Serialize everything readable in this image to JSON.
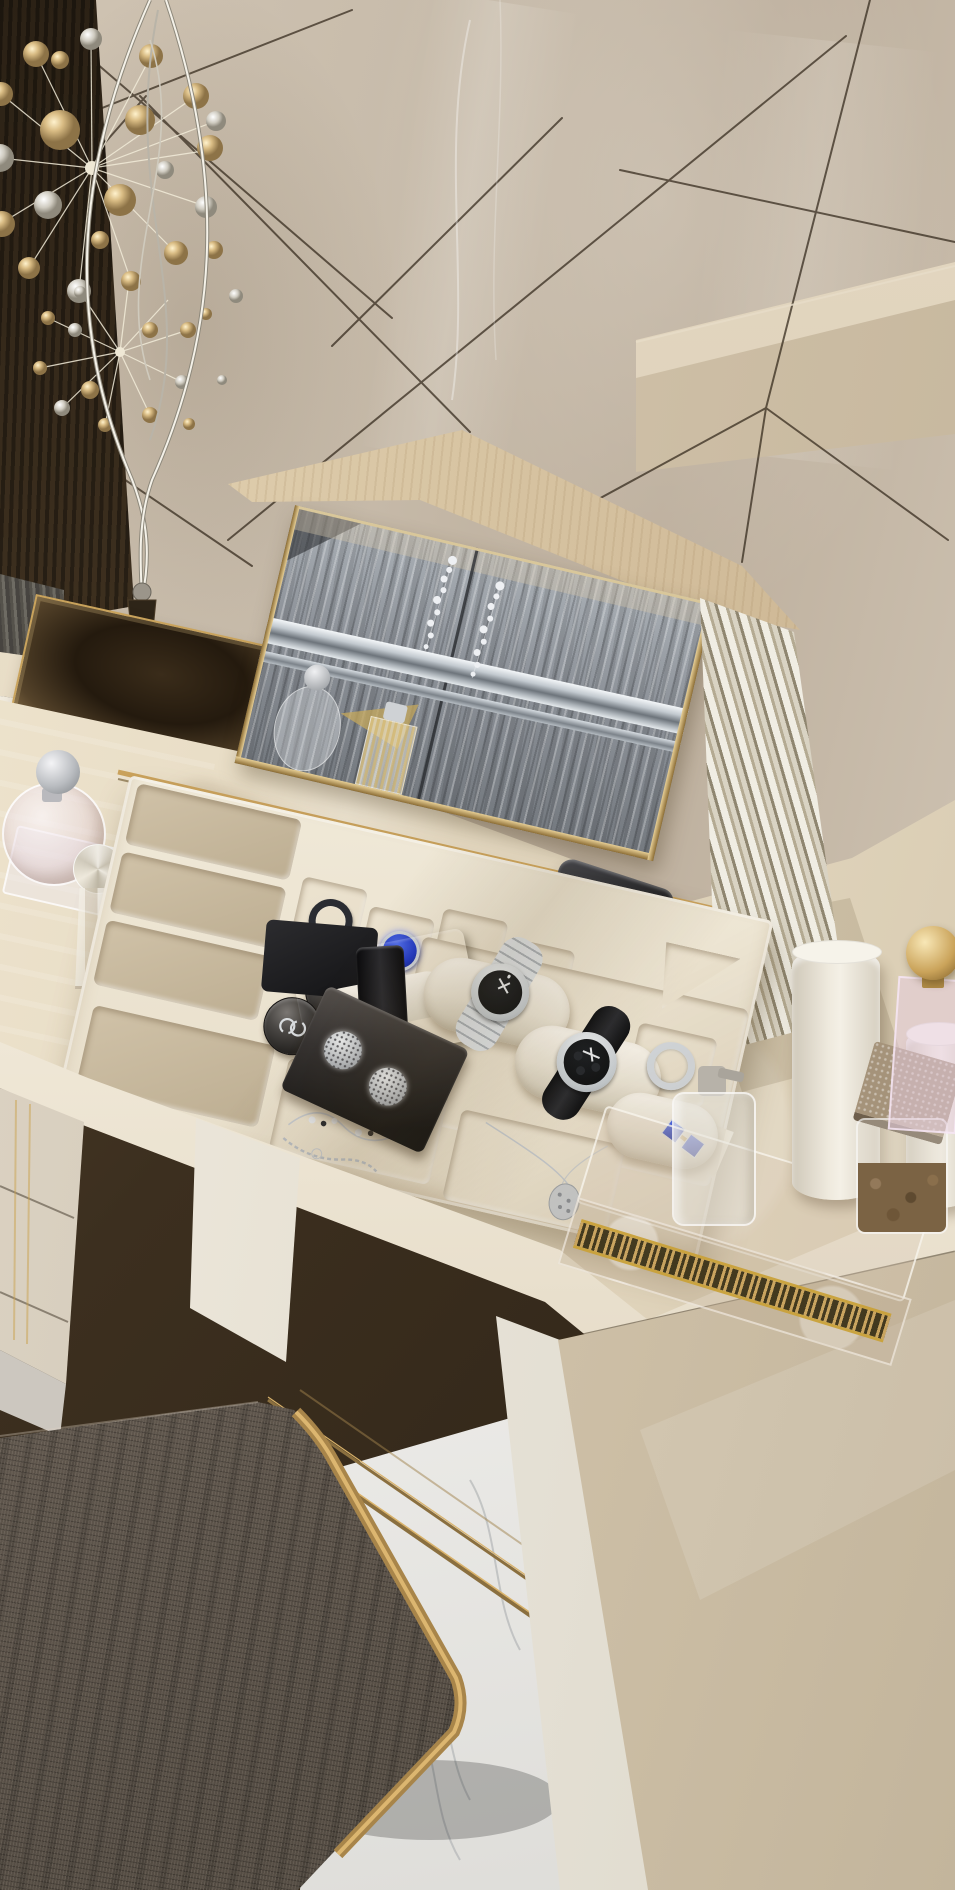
{
  "scene": {
    "type": "photorealistic interior render",
    "setting": "luxury bedroom vanity corner seen from above",
    "description": "A glossy beige vanity dressing table with an open lid revealing a tilted mirror and a cream jewelry organizer tray filled with watches, rings and necklaces. A chrome sputnik-style lamp with golden discs stands on a gold mirrored tray at the left, perfume bottles sit on the marble counter, an acrylic tray with candles and bottles sits on the right counter, and a gray woven stool with gold legs stands on white marble flooring.",
    "objects": [
      {
        "name": "wall-panels",
        "description": "glossy beige wall tiles with thin dark diagonal seams"
      },
      {
        "name": "floating-ledge",
        "description": "beige wall ledge on the right"
      },
      {
        "name": "dark-wood-panel",
        "description": "dark lacquered panel at far left"
      },
      {
        "name": "gray-curtain",
        "description": "striped gray fabric sliver at left edge"
      },
      {
        "name": "sputnik-floor-lamp",
        "description": "chrome twisted-wire lamp with golden disc bursts"
      },
      {
        "name": "gold-mirror-tray",
        "description": "square mirrored brass tray under the lamp base"
      },
      {
        "name": "round-perfume-flacon",
        "description": "round glass flacon with silver ball cap"
      },
      {
        "name": "crystal-perfume-bottle",
        "description": "faceted crystal bottle with sphere stopper"
      },
      {
        "name": "vanity-lid",
        "description": "open beige wooden lid of the vanity"
      },
      {
        "name": "vanity-mirror",
        "description": "mirror on lid underside reflecting gray wavy wardrobe with chrome inlays and crystal tassels"
      },
      {
        "name": "louvered-lid-edge",
        "description": "slatted trim at the right edge of the lid"
      },
      {
        "name": "black-accessory-case",
        "description": "black rounded case behind the tray"
      },
      {
        "name": "jewelry-tray",
        "description": "cream molded organizer with compartments"
      },
      {
        "name": "chanel-jars",
        "description": "two dark round jars with interlocked-C logo"
      },
      {
        "name": "ring-box",
        "description": "open black box with white cushion and black strap"
      },
      {
        "name": "earring-box",
        "description": "black box with two sparkling round medallions"
      },
      {
        "name": "wristwatch-silver",
        "description": "steel bracelet watch with black dial on cushion"
      },
      {
        "name": "wristwatch-chronograph",
        "description": "black strap chronograph on cushion"
      },
      {
        "name": "black-ring",
        "description": "dark ring in back compartment"
      },
      {
        "name": "sapphire-ring",
        "description": "silver ring with large blue stone"
      },
      {
        "name": "silver-ring",
        "description": "plain silver ring in right compartment"
      },
      {
        "name": "sapphire-cufflinks",
        "description": "pair of square blue cufflinks"
      },
      {
        "name": "bead-necklace",
        "description": "thin necklace with alternating beads"
      },
      {
        "name": "chain-bracelet",
        "description": "silver link bracelet"
      },
      {
        "name": "pendant-necklace",
        "description": "chain with oval filigree pendant"
      },
      {
        "name": "marble-countertop",
        "description": "cream marble desktop"
      },
      {
        "name": "gold-hinge-trim",
        "description": "brass trim line along the lid hinge"
      },
      {
        "name": "desk-front-edge",
        "description": "bright lacquered front edge of the desk"
      },
      {
        "name": "left-drawer-unit",
        "description": "glossy drawer fronts at lower left"
      },
      {
        "name": "under-desk-shadow",
        "description": "dark recess below the desktop"
      },
      {
        "name": "acrylic-vanity-tray",
        "description": "clear tray with gold greek-key band"
      },
      {
        "name": "pump-bottle",
        "description": "glass dispenser bottle"
      },
      {
        "name": "pillar-candles",
        "description": "two white cylinder candles"
      },
      {
        "name": "potpourri-jar",
        "description": "glass jar with brown potpourri"
      },
      {
        "name": "pink-acrylic-perfume-stand",
        "description": "lilac acrylic bottle with gold sphere stopper"
      },
      {
        "name": "right-drawer-pedestal",
        "description": "beige pedestal with radiating seams"
      },
      {
        "name": "marble-floor",
        "description": "white marble floor with gray veins"
      },
      {
        "name": "stool-seat",
        "description": "gray-brown woven fabric stool"
      },
      {
        "name": "stool-gold-frame",
        "description": "brass frame, rails and curved legs of the stool"
      }
    ]
  },
  "palette": {
    "wall": "#c8bcab",
    "seam": "#32271a",
    "panelDark": "#2b2115",
    "panelLight": "#4a3a26",
    "curtainA": "#55524b",
    "curtainB": "#6e6b63",
    "marbleLight": "#efe5cf",
    "marbleMid": "#e4d8c0",
    "marbleDark": "#d5c8ae",
    "edgeWhite": "#f8f4ea",
    "wood": "#d8c5a3",
    "woodDark": "#c3ad88",
    "mirrorGray": "#8e939a",
    "mirrorLight": "#aab0b6",
    "mirrorDark": "#74797f",
    "chromeLight": "#f4f7f9",
    "chromeDark": "#6d747b",
    "goldLight": "#e7cf96",
    "goldMid": "#c9a35c",
    "goldDark": "#8a6b33",
    "trayCream": "#f0e9d8",
    "wellCream": "#e7ddc8",
    "suede": "#d0c2a8",
    "suedeDark": "#bdae92",
    "silver": "#d3d7db",
    "dialBlack": "#101214",
    "sapphire": "#2038c4",
    "sapphireLight": "#4f6ceb",
    "fabric": "#6b6157",
    "fabricLight": "#7d7468",
    "fabricDark": "#544c43",
    "floorWhite": "#e9e8e5",
    "floorVein": "#b7b9ba",
    "pedestal": "#d2c4ab",
    "pedestalLight": "#e2d6c0",
    "underShadow": "#3c2f1f",
    "underShadowLight": "#5a4830",
    "brown": "#7b6344"
  }
}
